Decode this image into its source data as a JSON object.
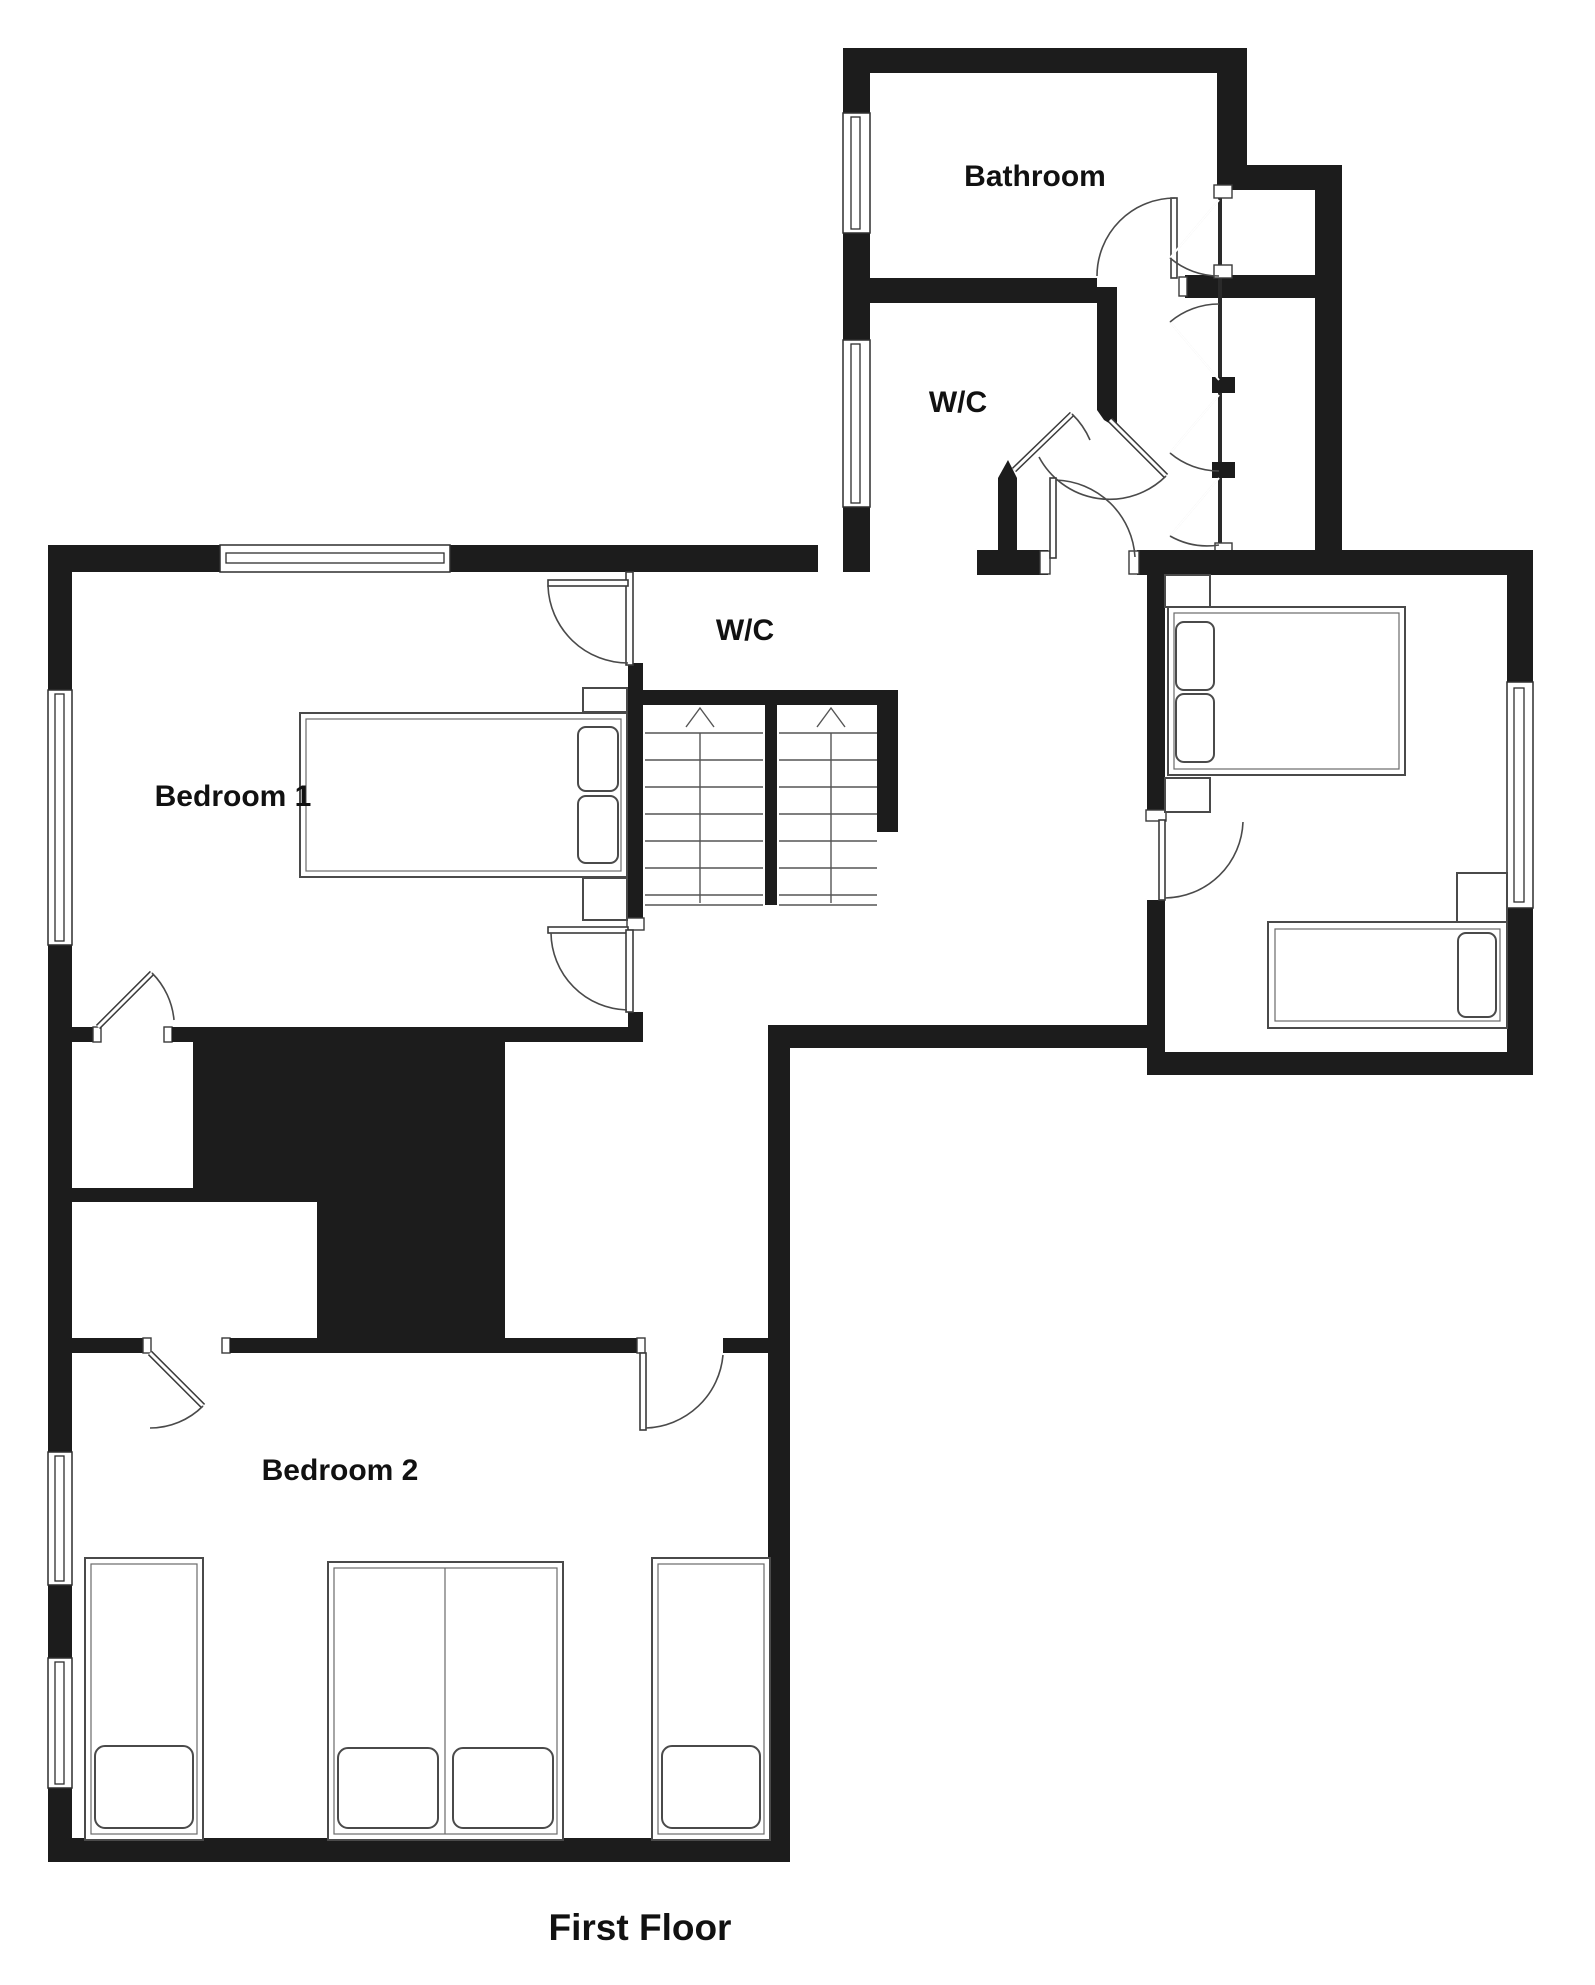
{
  "title": "First Floor",
  "rooms": {
    "bathroom": {
      "label": "Bathroom",
      "features": [
        "window-left-wall",
        "door-bottom-right",
        "closet-bank-east"
      ]
    },
    "wc_upper": {
      "label": "W/C",
      "features": [
        "window-left-wall",
        "diagonal-entry-door"
      ]
    },
    "wc_lower": {
      "label": "W/C",
      "features": [
        "door-from-bedroom-1-side"
      ]
    },
    "bedroom1": {
      "label": "Bedroom 1",
      "features": [
        "double-bed",
        "two-bedside-tables",
        "walk-in-closet",
        "window-top-wall",
        "window-left-wall"
      ]
    },
    "bedroom2": {
      "label": "Bedroom 2",
      "features": [
        "three-single-beds",
        "walk-in-closet",
        "two-windows-left-wall",
        "two-entry-doors"
      ]
    },
    "bedroom3": {
      "label": "",
      "features": [
        "double-bed",
        "single-bed",
        "three-bedside-tables",
        "window-right-wall",
        "door-left-wall"
      ]
    }
  },
  "stairs": {
    "flights": 2,
    "direction": "up",
    "treads_per_flight": 7
  },
  "colors": {
    "wall": "#1c1c1c",
    "line": "#4a4a4a",
    "background": "#ffffff",
    "text": "#111111"
  }
}
